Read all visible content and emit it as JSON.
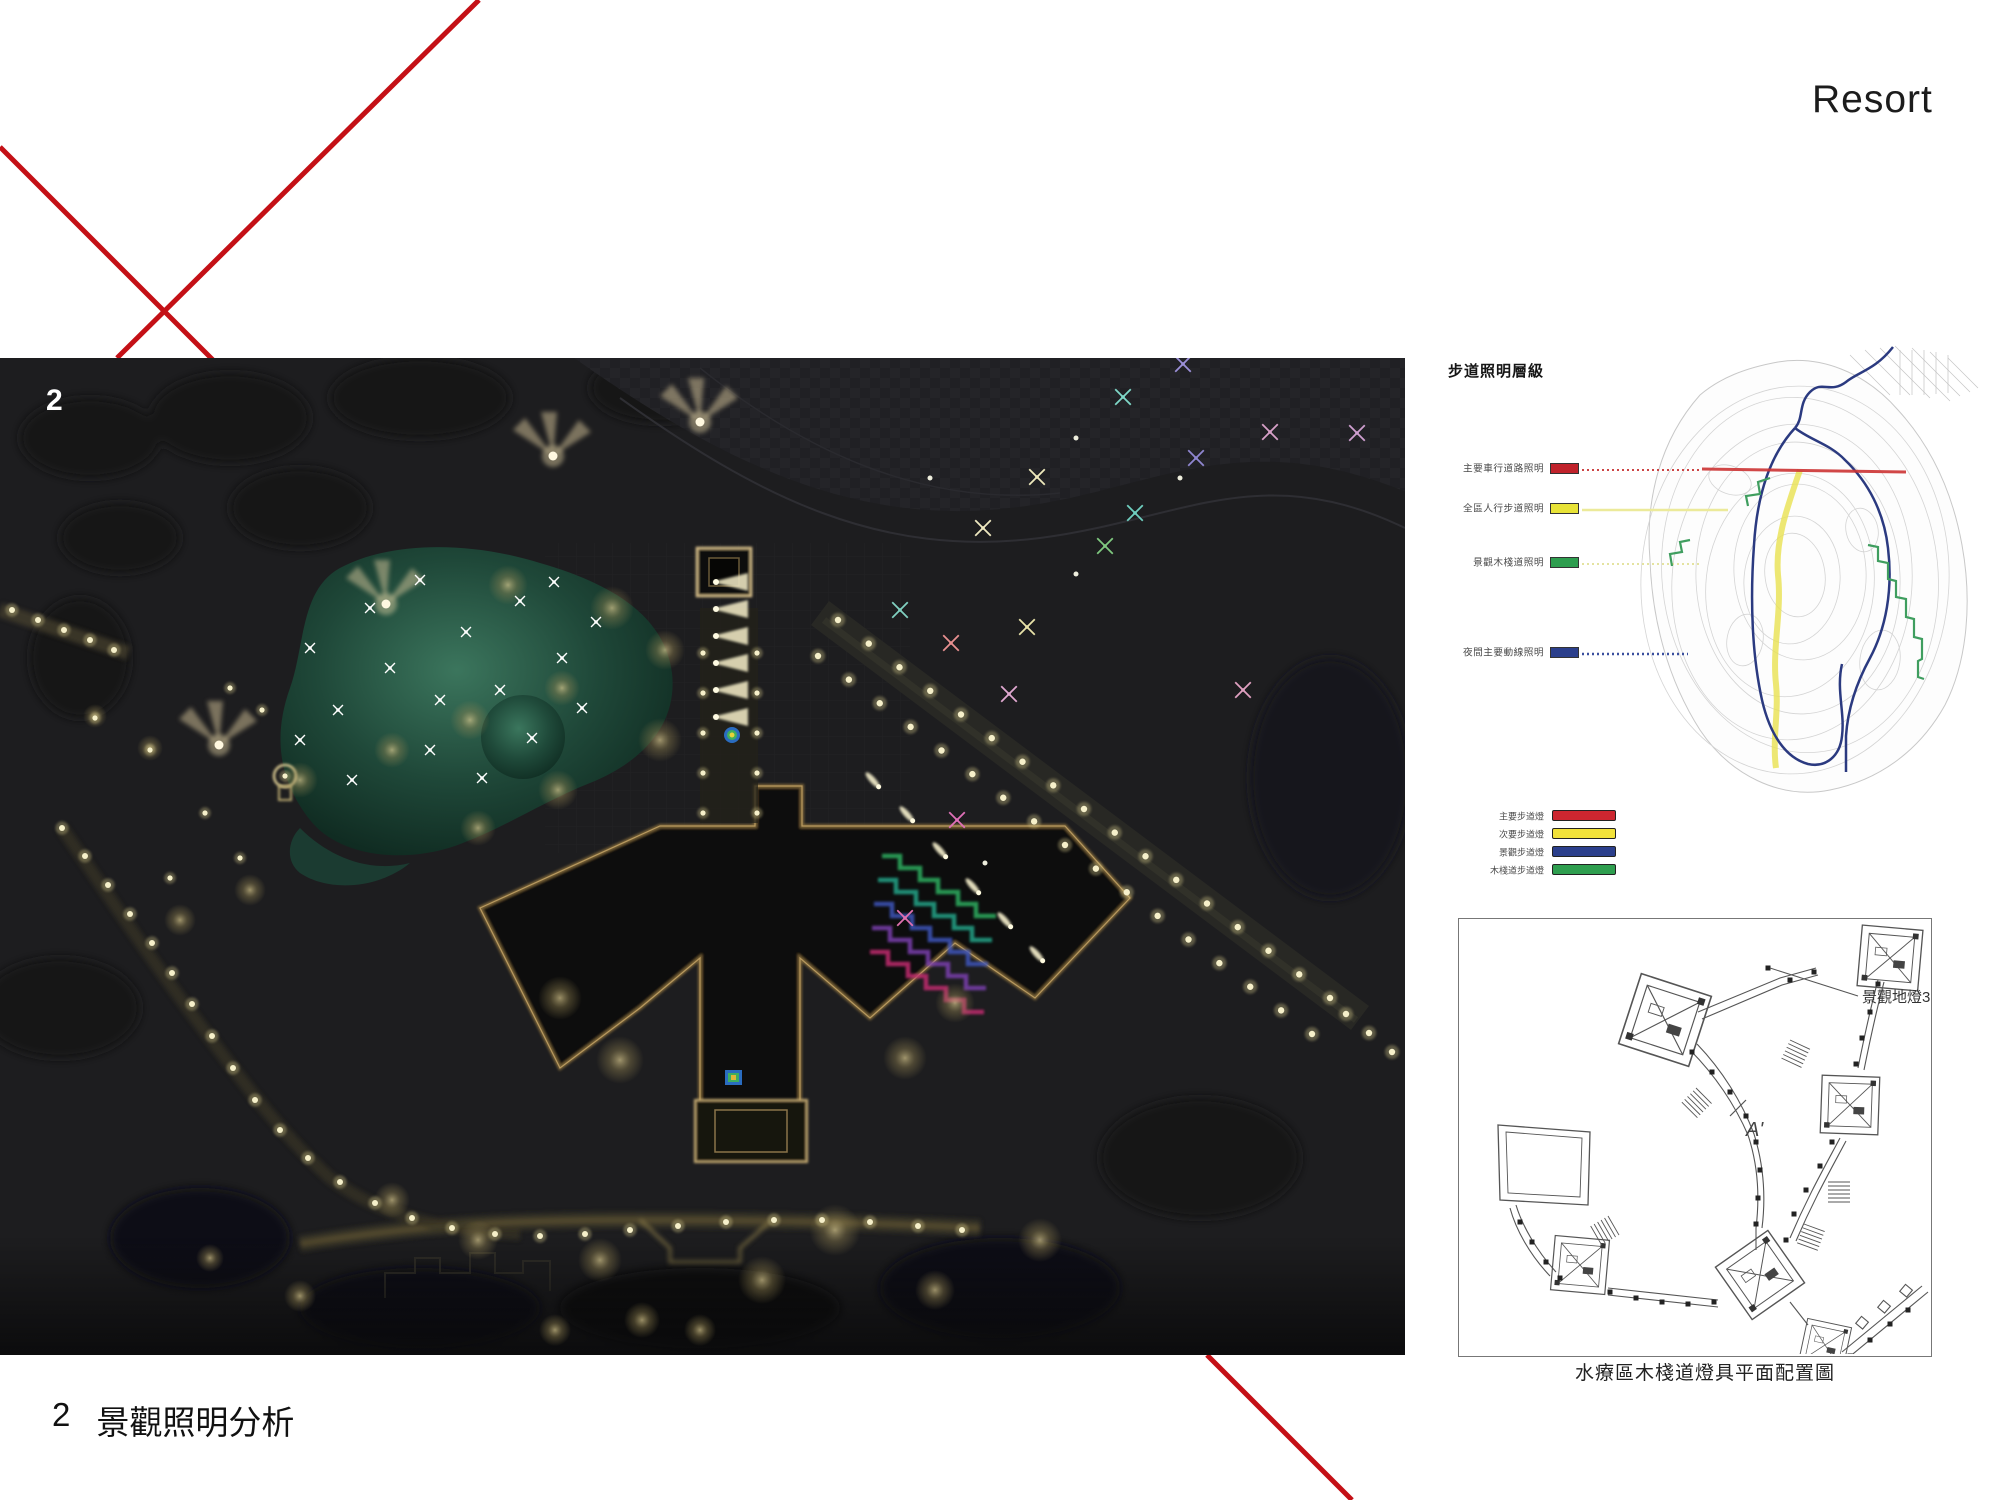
{
  "page": {
    "brand": "Resort",
    "figure_number": "2",
    "caption_number": "2",
    "caption_text": "景觀照明分析"
  },
  "colors": {
    "accent_red": "#c41016",
    "lake_teal": "#2a5c4a",
    "warm_light": "#f5efc8"
  },
  "walkway_legend": {
    "title": "步道照明層級",
    "items": [
      {
        "label": "主要車行道路照明",
        "color": "#c0222b"
      },
      {
        "label": "全區人行步道照明",
        "color": "#e8e337"
      },
      {
        "label": "景觀木棧道照明",
        "color": "#2e9e4f"
      },
      {
        "label": "夜間主要動線照明",
        "color": "#2b3f8c"
      }
    ]
  },
  "fixture_legend": {
    "items": [
      {
        "label": "主要步道燈",
        "color": "#cc2630"
      },
      {
        "label": "次要步道燈",
        "color": "#f2e23a"
      },
      {
        "label": "景觀步道燈",
        "color": "#2b3f8c"
      },
      {
        "label": "木棧道步道燈",
        "color": "#2e9e4f"
      }
    ]
  },
  "spa_plan": {
    "annotation": "景觀地燈3",
    "section_label": "A'",
    "caption": "水療區木棧道燈具平面配置圖"
  },
  "scene": {
    "fans": [
      [
        553,
        98
      ],
      [
        700,
        64
      ],
      [
        386,
        246
      ],
      [
        219,
        387
      ]
    ],
    "wedges": {
      "x": 712,
      "y0": 224,
      "step": 27,
      "count": 6
    },
    "lake_sparkles": [
      [
        370,
        250
      ],
      [
        420,
        222
      ],
      [
        466,
        274
      ],
      [
        520,
        243
      ],
      [
        562,
        300
      ],
      [
        500,
        332
      ],
      [
        440,
        342
      ],
      [
        390,
        310
      ],
      [
        338,
        352
      ],
      [
        310,
        290
      ],
      [
        430,
        392
      ],
      [
        482,
        420
      ],
      [
        532,
        380
      ],
      [
        582,
        350
      ],
      [
        352,
        422
      ],
      [
        300,
        382
      ],
      [
        596,
        264
      ],
      [
        554,
        224
      ]
    ],
    "colored_sparkles": [
      [
        1123,
        39,
        "#7fd8c8"
      ],
      [
        1183,
        6,
        "#9b8fd8"
      ],
      [
        1037,
        119,
        "#eee9bc"
      ],
      [
        1270,
        74,
        "#d8a0c8"
      ],
      [
        1357,
        75,
        "#cf9fd0"
      ],
      [
        1196,
        100,
        "#8f86d0"
      ],
      [
        1135,
        155,
        "#6fcfc0"
      ],
      [
        1105,
        188,
        "#7fc87f"
      ],
      [
        983,
        170,
        "#efe9c0"
      ],
      [
        1027,
        269,
        "#e8e2a8"
      ],
      [
        900,
        252,
        "#80d0c0"
      ],
      [
        951,
        285,
        "#e89090"
      ],
      [
        1009,
        336,
        "#e0a8d0"
      ],
      [
        957,
        462,
        "#e070b8"
      ],
      [
        1243,
        332,
        "#e0a0c0"
      ],
      [
        905,
        560,
        "#e070b0"
      ]
    ],
    "white_specks": [
      [
        1076,
        80
      ],
      [
        1076,
        216
      ],
      [
        985,
        505
      ],
      [
        1180,
        120
      ],
      [
        930,
        120
      ]
    ],
    "avenue_rows": [
      {
        "from": [
          838,
          262
        ],
        "to": [
          1330,
          640
        ],
        "n": 17
      },
      {
        "from": [
          818,
          298
        ],
        "to": [
          1312,
          676
        ],
        "n": 17
      },
      {
        "from": [
          1346,
          656
        ],
        "to": [
          1392,
          694
        ],
        "n": 3
      }
    ],
    "teardrops": [
      [
        912,
        462
      ],
      [
        945,
        498
      ],
      [
        978,
        534
      ],
      [
        1010,
        568
      ],
      [
        1042,
        602
      ],
      [
        878,
        428
      ]
    ],
    "path_dots": [
      [
        62,
        470
      ],
      [
        85,
        498
      ],
      [
        108,
        527
      ],
      [
        130,
        556
      ],
      [
        152,
        585
      ],
      [
        172,
        615
      ],
      [
        192,
        646
      ],
      [
        212,
        678
      ],
      [
        233,
        710
      ],
      [
        255,
        742
      ],
      [
        280,
        772
      ],
      [
        308,
        800
      ],
      [
        340,
        824
      ],
      [
        375,
        845
      ],
      [
        412,
        860
      ],
      [
        452,
        870
      ],
      [
        495,
        876
      ],
      [
        540,
        878
      ],
      [
        585,
        876
      ],
      [
        630,
        872
      ],
      [
        678,
        868
      ],
      [
        726,
        864
      ],
      [
        774,
        862
      ],
      [
        822,
        862
      ],
      [
        870,
        864
      ],
      [
        918,
        868
      ],
      [
        962,
        872
      ]
    ],
    "axis_dots": [
      [
        703,
        295
      ],
      [
        757,
        295
      ],
      [
        703,
        335
      ],
      [
        757,
        335
      ],
      [
        703,
        375
      ],
      [
        757,
        375
      ],
      [
        703,
        415
      ],
      [
        757,
        415
      ],
      [
        703,
        455
      ],
      [
        757,
        455
      ]
    ],
    "deck_dots": [
      [
        12,
        252
      ],
      [
        38,
        262
      ],
      [
        64,
        272
      ],
      [
        90,
        282
      ],
      [
        114,
        292
      ]
    ],
    "misc_dots": [
      [
        285,
        418
      ],
      [
        150,
        392
      ],
      [
        95,
        360
      ],
      [
        205,
        455
      ],
      [
        240,
        500
      ],
      [
        170,
        520
      ],
      [
        262,
        352
      ],
      [
        230,
        330
      ]
    ],
    "canopies": [
      [
        508,
        227,
        20
      ],
      [
        612,
        250,
        22
      ],
      [
        665,
        292,
        20
      ],
      [
        562,
        330,
        18
      ],
      [
        470,
        362,
        20
      ],
      [
        392,
        392,
        18
      ],
      [
        300,
        422,
        18
      ],
      [
        660,
        382,
        22
      ],
      [
        558,
        432,
        20
      ],
      [
        478,
        470,
        18
      ],
      [
        250,
        532,
        16
      ],
      [
        180,
        562,
        16
      ],
      [
        560,
        640,
        22
      ],
      [
        620,
        702,
        24
      ],
      [
        905,
        700,
        22
      ],
      [
        955,
        645,
        20
      ],
      [
        835,
        872,
        26
      ],
      [
        762,
        922,
        24
      ],
      [
        600,
        902,
        22
      ],
      [
        478,
        882,
        20
      ],
      [
        392,
        842,
        18
      ],
      [
        1040,
        882,
        22
      ],
      [
        935,
        932,
        20
      ],
      [
        642,
        962,
        18
      ],
      [
        700,
        972,
        16
      ],
      [
        555,
        972,
        16
      ],
      [
        300,
        938,
        16
      ],
      [
        210,
        900,
        14
      ],
      [
        150,
        390,
        13
      ],
      [
        95,
        358,
        12
      ]
    ]
  },
  "plan_dots": [
    [
      232,
      132
    ],
    [
      252,
      152
    ],
    [
      270,
      172
    ],
    [
      286,
      196
    ],
    [
      296,
      222
    ],
    [
      300,
      250
    ],
    [
      298,
      278
    ],
    [
      296,
      304
    ],
    [
      418,
      64
    ],
    [
      410,
      92
    ],
    [
      402,
      118
    ],
    [
      396,
      144
    ],
    [
      372,
      222
    ],
    [
      360,
      246
    ],
    [
      346,
      270
    ],
    [
      334,
      294
    ],
    [
      326,
      320
    ],
    [
      150,
      372
    ],
    [
      176,
      378
    ],
    [
      202,
      382
    ],
    [
      228,
      384
    ],
    [
      254,
      382
    ],
    [
      308,
      48
    ],
    [
      330,
      60
    ],
    [
      354,
      52
    ],
    [
      60,
      302
    ],
    [
      72,
      322
    ],
    [
      86,
      342
    ],
    [
      100,
      358
    ],
    [
      390,
      436
    ],
    [
      410,
      420
    ],
    [
      430,
      404
    ],
    [
      448,
      390
    ]
  ]
}
